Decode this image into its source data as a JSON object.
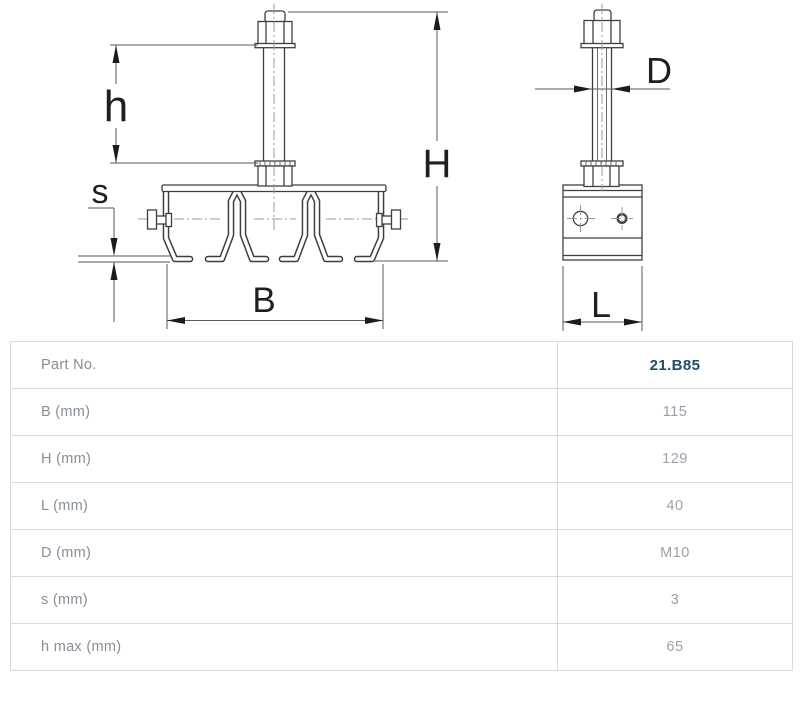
{
  "drawing": {
    "dimension_labels": {
      "h": "h",
      "s": "s",
      "B": "B",
      "H": "H",
      "D": "D",
      "L": "L"
    }
  },
  "table": {
    "rows": [
      {
        "label": "Part No.",
        "value": "21.B85",
        "emphasis": true
      },
      {
        "label": "B (mm)",
        "value": "115"
      },
      {
        "label": "H (mm)",
        "value": "129"
      },
      {
        "label": "L (mm)",
        "value": "40"
      },
      {
        "label": "D (mm)",
        "value": "M10"
      },
      {
        "label": "s (mm)",
        "value": "3"
      },
      {
        "label": "h max (mm)",
        "value": "65"
      }
    ]
  },
  "colors": {
    "part_number": "#1b4e68",
    "table_border": "#d9dbde",
    "label_text": "#878e98",
    "value_text": "#9aa1a8",
    "outline": "#3f3f3f"
  }
}
